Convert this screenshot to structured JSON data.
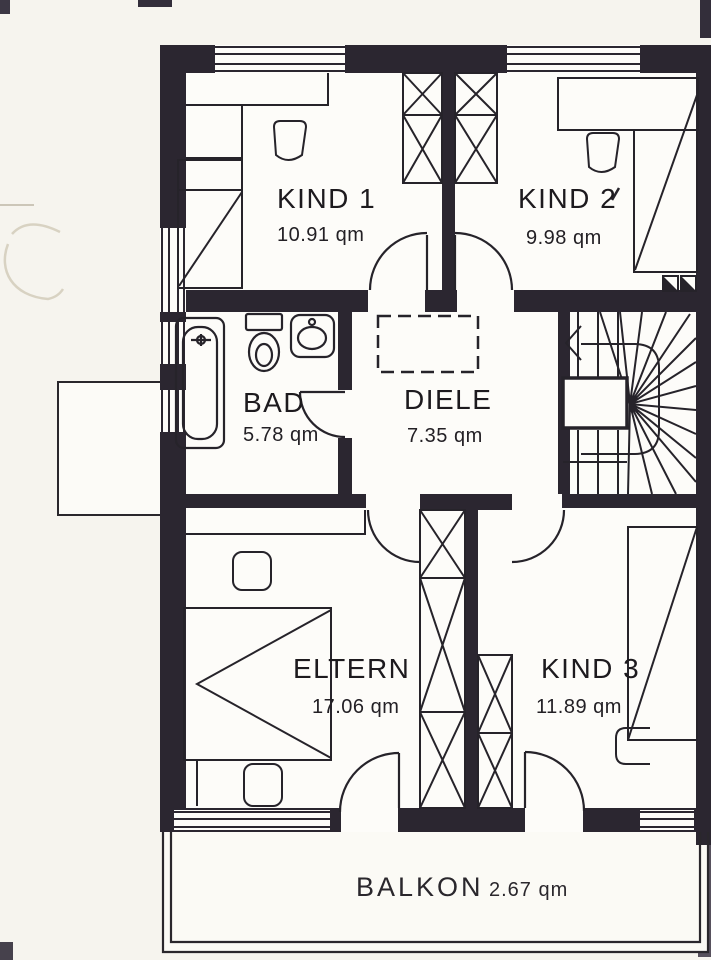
{
  "plan": {
    "rooms": [
      {
        "id": "kind1",
        "label": "KIND 1",
        "area": "10.91 qm"
      },
      {
        "id": "kind2",
        "label": "KIND 2",
        "area": "9.98 qm"
      },
      {
        "id": "bad",
        "label": "BAD",
        "area": "5.78 qm"
      },
      {
        "id": "diele",
        "label": "DIELE",
        "area": "7.35 qm"
      },
      {
        "id": "eltern",
        "label": "ELTERN",
        "area": "17.06 qm"
      },
      {
        "id": "kind3",
        "label": "KIND 3",
        "area": "11.89 qm"
      },
      {
        "id": "balkon",
        "label": "BALKON",
        "area": "2.67 qm"
      }
    ],
    "unit_suffix": "qm"
  },
  "colors": {
    "wall": "#2b2630",
    "line": "#26232a",
    "paper": "#f6f4ee",
    "interior": "#fdfcf9"
  }
}
